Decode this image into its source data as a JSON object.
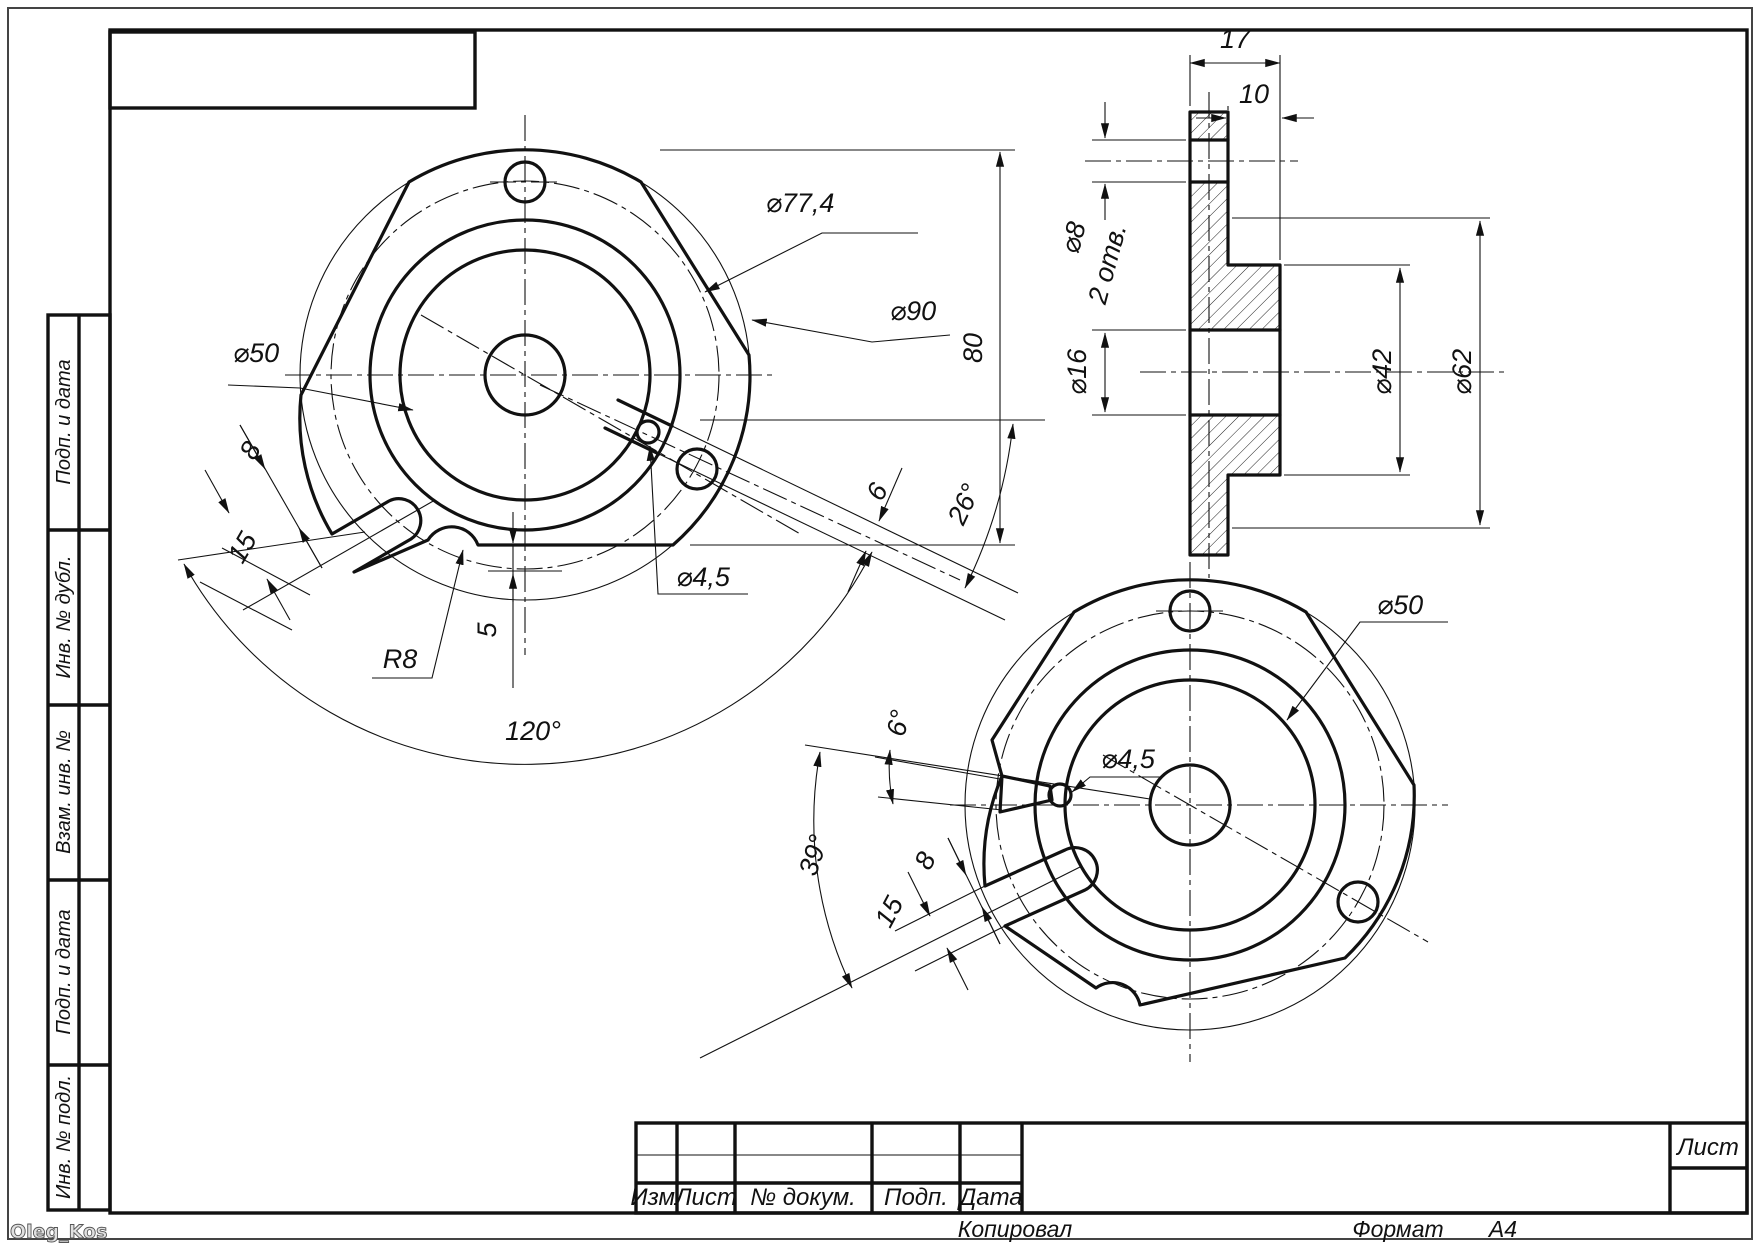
{
  "page": {
    "watermark": "Oleg_Kos",
    "stamps_left": [
      {
        "label": "Подп. и дата"
      },
      {
        "label": "Инв. № дубл."
      },
      {
        "label": "Взам. инв. №"
      },
      {
        "label": "Подп. и дата"
      },
      {
        "label": "Инв. № подл."
      }
    ],
    "title_block": {
      "col_izm": "Изм.",
      "col_list": "Лист",
      "col_doc": "№ докум.",
      "col_podp": "Подп.",
      "col_data": "Дата",
      "sheet_label": "Лист",
      "footer_left": "Копировал",
      "footer_format_label": "Формат",
      "footer_format_value": "А4"
    }
  },
  "views": {
    "front": {
      "d77": "⌀77,4",
      "d90": "⌀90",
      "d50": "⌀50",
      "slot_w": "8",
      "slot_l": "15",
      "r8": "R8",
      "flat": "5",
      "d45": "⌀4,5",
      "key_w": "6",
      "a26": "26°",
      "a120": "120°",
      "h80": "80"
    },
    "section": {
      "w17": "17",
      "w10": "10",
      "d8": "⌀8",
      "d8_qty": "2 отв.",
      "d16": "⌀16",
      "d42": "⌀42",
      "d62": "⌀62"
    },
    "aux": {
      "d50": "⌀50",
      "d45": "⌀4,5",
      "a6": "6°",
      "a39": "39°",
      "slot_w": "8",
      "slot_l": "15"
    }
  }
}
